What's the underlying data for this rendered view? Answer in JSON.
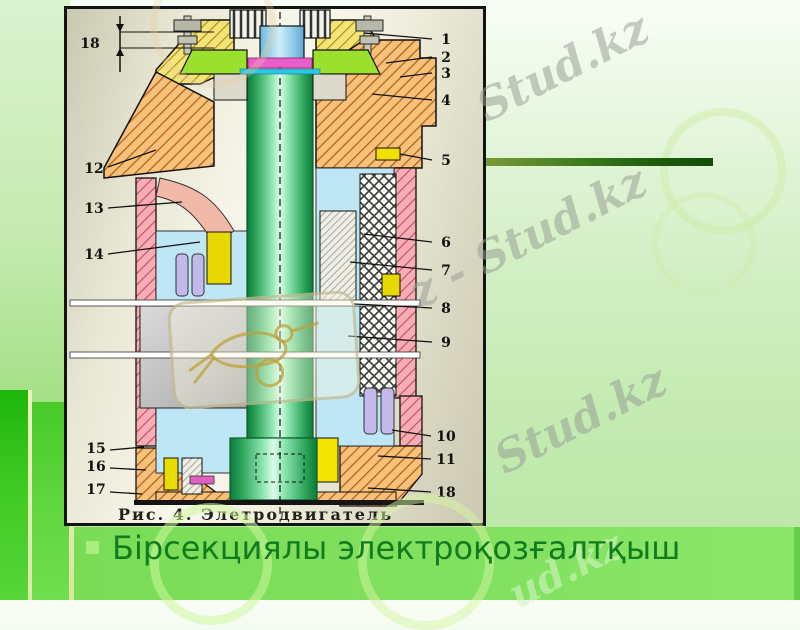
{
  "slide": {
    "bullet": {
      "label": "Бірсекциялы электроқозғалтқыш"
    },
    "colors": {
      "accent_bar": "#1d5c0e",
      "bullet_square": "#a9ed7f",
      "bullet_text": "#117c1d",
      "band_green": "#7ddc5b",
      "step_green": "#2fbf18"
    }
  },
  "figure": {
    "caption": "Рис. 4. Элетродвигатель",
    "dimension_label": "18",
    "callouts": [
      {
        "label": "1",
        "tx": 382,
        "ty": 38,
        "line": [
          368,
          33,
          300,
          27
        ]
      },
      {
        "label": "2",
        "tx": 382,
        "ty": 56,
        "line": [
          368,
          51,
          322,
          57
        ]
      },
      {
        "label": "3",
        "tx": 382,
        "ty": 72,
        "line": [
          368,
          67,
          336,
          71
        ]
      },
      {
        "label": "4",
        "tx": 382,
        "ty": 99,
        "line": [
          368,
          94,
          308,
          88
        ]
      },
      {
        "label": "5",
        "tx": 382,
        "ty": 159,
        "line": [
          368,
          154,
          336,
          148
        ]
      },
      {
        "label": "6",
        "tx": 382,
        "ty": 241,
        "line": [
          368,
          236,
          300,
          228
        ]
      },
      {
        "label": "7",
        "tx": 382,
        "ty": 269,
        "line": [
          368,
          264,
          286,
          256
        ]
      },
      {
        "label": "8",
        "tx": 382,
        "ty": 307,
        "line": [
          368,
          302,
          290,
          298
        ]
      },
      {
        "label": "9",
        "tx": 382,
        "ty": 341,
        "line": [
          368,
          336,
          284,
          330
        ]
      },
      {
        "label": "10",
        "tx": 382,
        "ty": 435,
        "line": [
          367,
          430,
          328,
          424
        ]
      },
      {
        "label": "11",
        "tx": 382,
        "ty": 458,
        "line": [
          367,
          453,
          314,
          450
        ]
      },
      {
        "label": "18",
        "tx": 382,
        "ty": 491,
        "line": [
          367,
          486,
          304,
          482
        ]
      },
      {
        "label": "12",
        "tx": 30,
        "ty": 167,
        "line": [
          44,
          161,
          92,
          144
        ]
      },
      {
        "label": "13",
        "tx": 30,
        "ty": 207,
        "line": [
          44,
          202,
          118,
          196
        ]
      },
      {
        "label": "14",
        "tx": 30,
        "ty": 253,
        "line": [
          44,
          248,
          136,
          236
        ]
      },
      {
        "label": "15",
        "tx": 32,
        "ty": 447,
        "line": [
          46,
          444,
          80,
          441
        ]
      },
      {
        "label": "16",
        "tx": 32,
        "ty": 465,
        "line": [
          46,
          462,
          82,
          464
        ]
      },
      {
        "label": "17",
        "tx": 32,
        "ty": 488,
        "line": [
          46,
          486,
          78,
          488
        ]
      }
    ]
  },
  "watermarks": {
    "top_right": "Stud.kz",
    "mid_right": "z - Stud.kz",
    "lower_right": "Stud.kz",
    "bottom_right": "ud.kz"
  }
}
